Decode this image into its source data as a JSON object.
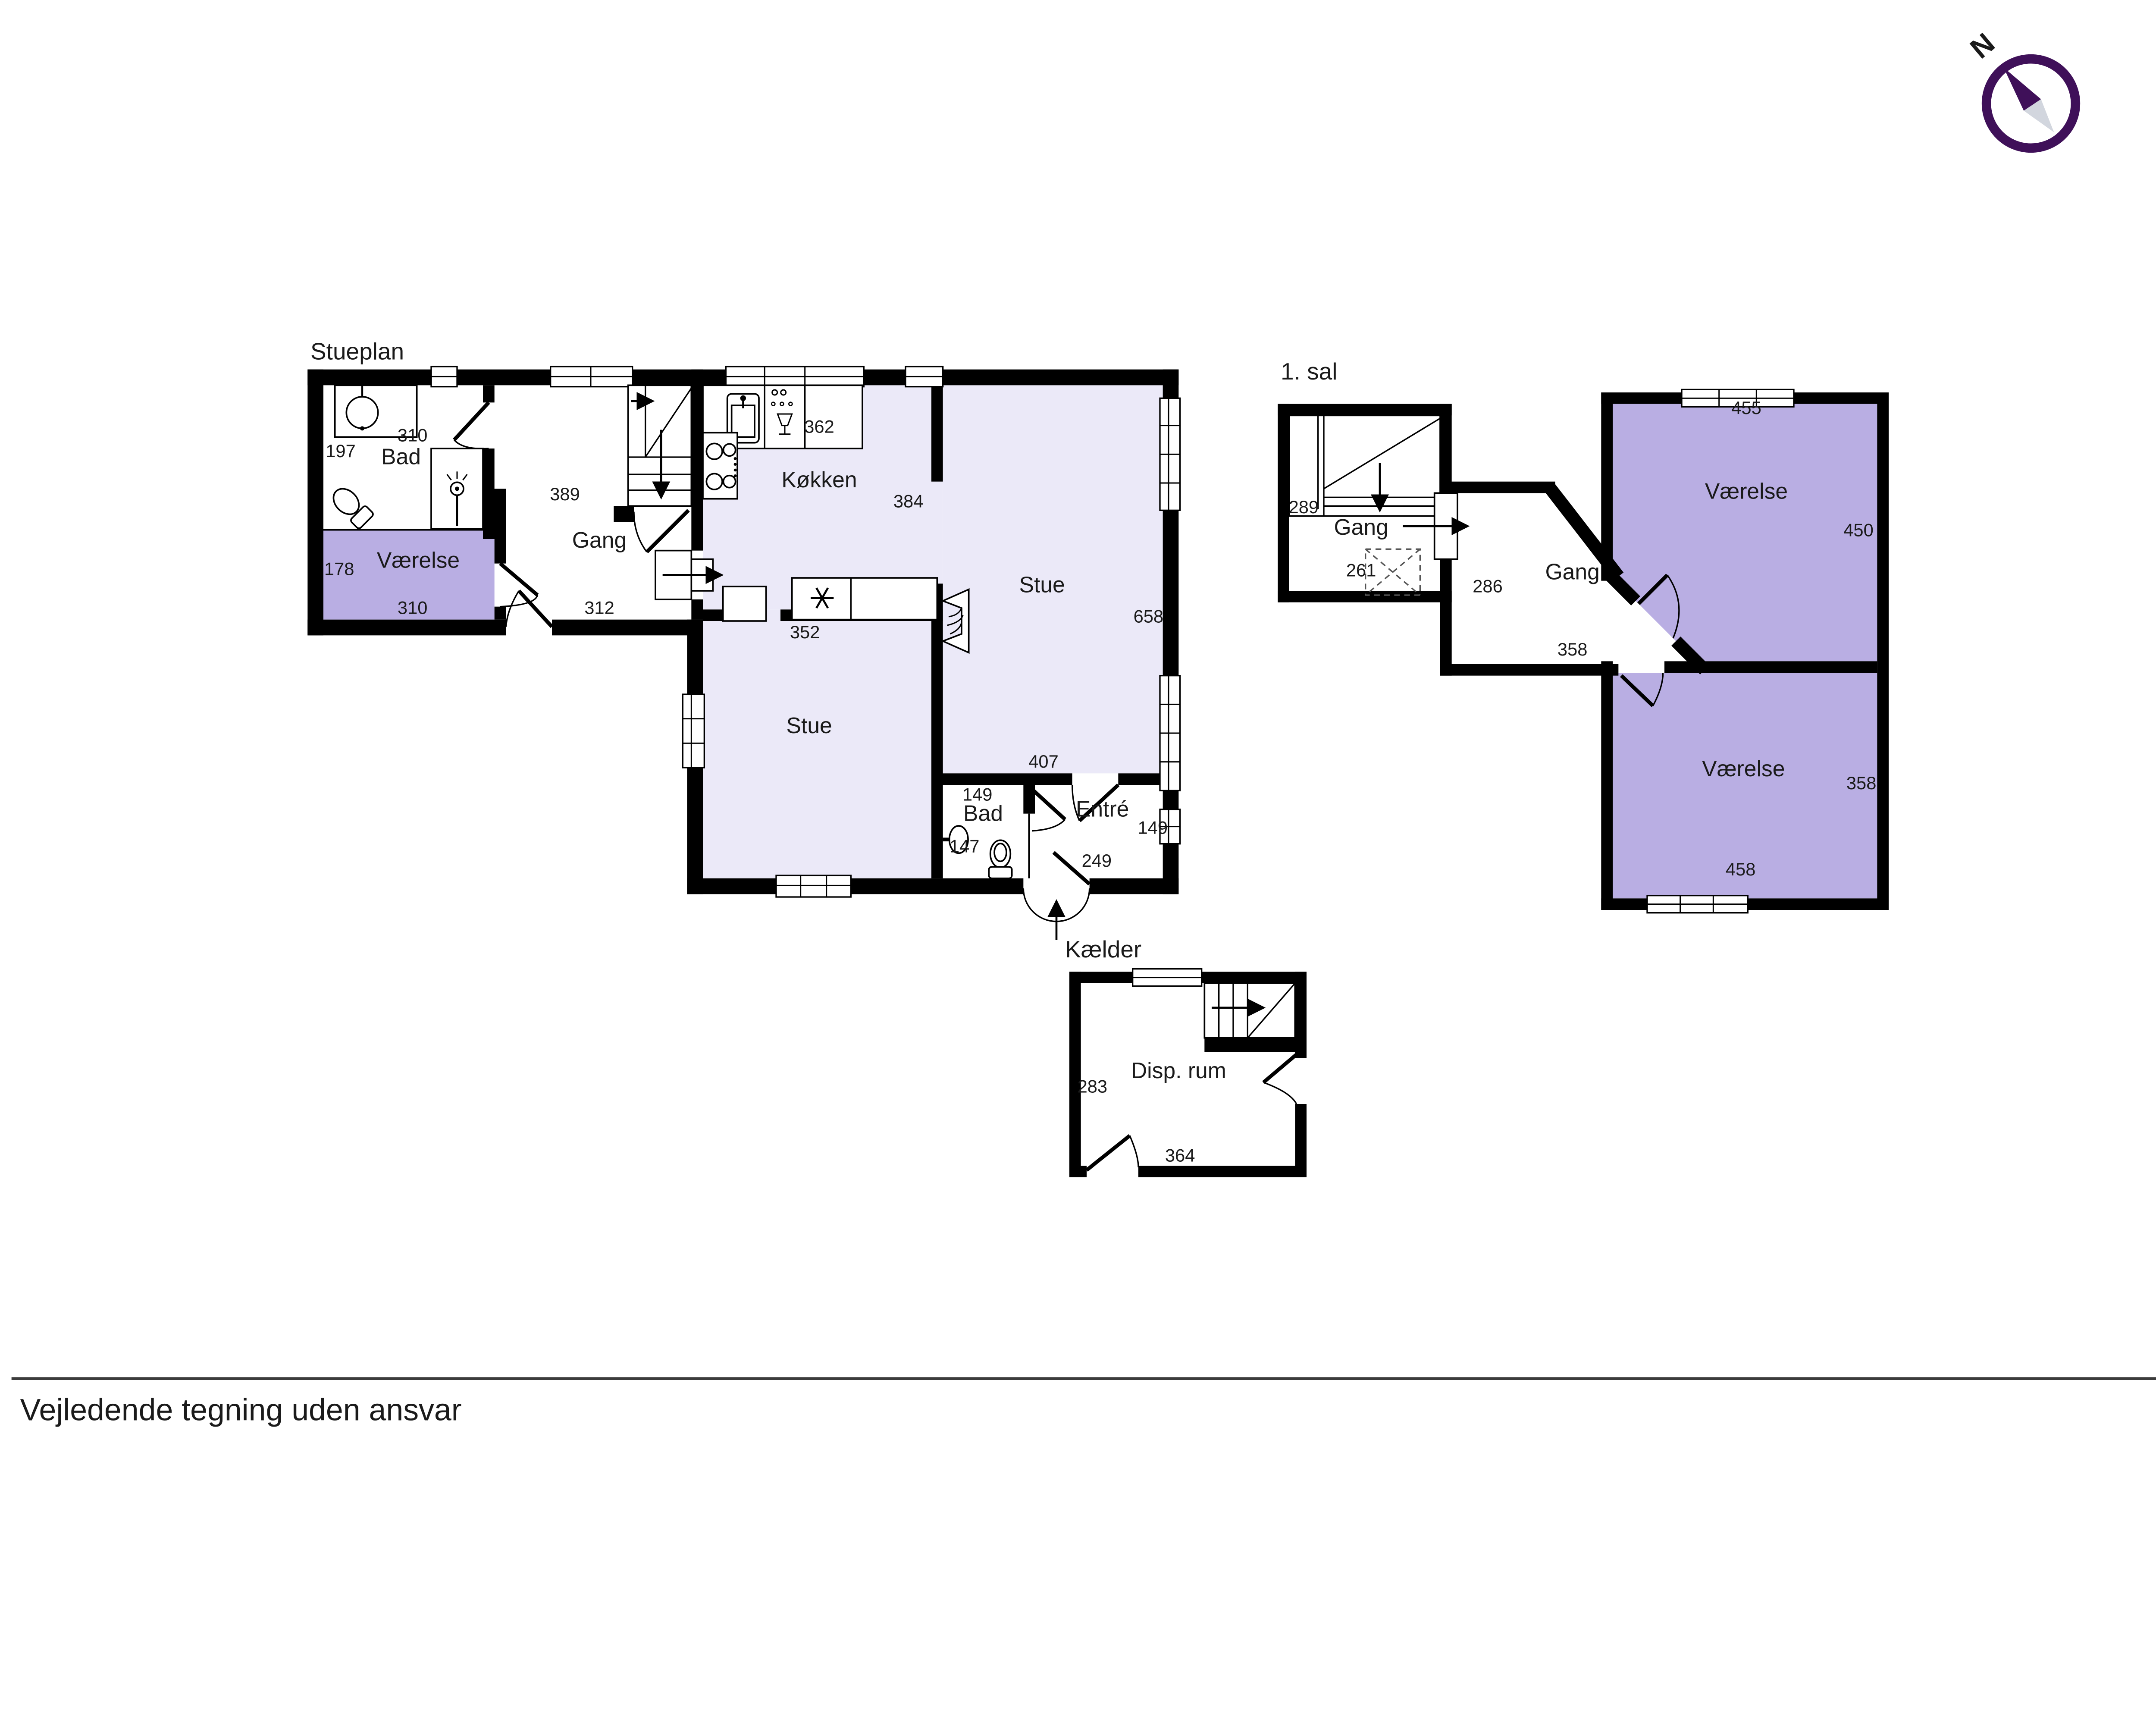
{
  "colors": {
    "wall": "#000000",
    "room_light": "#ebe9f8",
    "room_medium": "#b9aee3",
    "compass_purple": "#3f1059",
    "compass_gray": "#d2d6de"
  },
  "disclaimer": "Vejledende tegning uden ansvar",
  "compass": {
    "north_label": "N"
  },
  "stueplan": {
    "title": "Stueplan",
    "bad": {
      "label": "Bad",
      "top": "310",
      "left": "197"
    },
    "vaerelse": {
      "label": "Værelse",
      "left": "178",
      "bottom": "310"
    },
    "gang": {
      "label": "Gang",
      "top": "389",
      "bottom": "312"
    },
    "koekken": {
      "label": "Køkken",
      "top": "362",
      "right": "384",
      "bottom": "352"
    },
    "stue": {
      "label": "Stue",
      "right": "658",
      "bottom": "407"
    },
    "stue2": {
      "label": "Stue"
    },
    "bad2": {
      "label": "Bad",
      "top": "149",
      "left": "147"
    },
    "entre": {
      "label": "Entré",
      "right": "149",
      "bottom": "249"
    }
  },
  "foerste_sal": {
    "title": "1. sal",
    "gang1": {
      "label": "Gang",
      "left": "289",
      "bottom": "261"
    },
    "gang2": {
      "label": "Gang",
      "left": "286",
      "bottom": "358"
    },
    "vaerelse1": {
      "label": "Værelse",
      "top": "455",
      "right": "450"
    },
    "vaerelse2": {
      "label": "Værelse",
      "right": "358",
      "bottom": "458"
    }
  },
  "kaelder": {
    "title": "Kælder",
    "disp_rum": {
      "label": "Disp. rum",
      "left": "283",
      "bottom": "364"
    }
  }
}
